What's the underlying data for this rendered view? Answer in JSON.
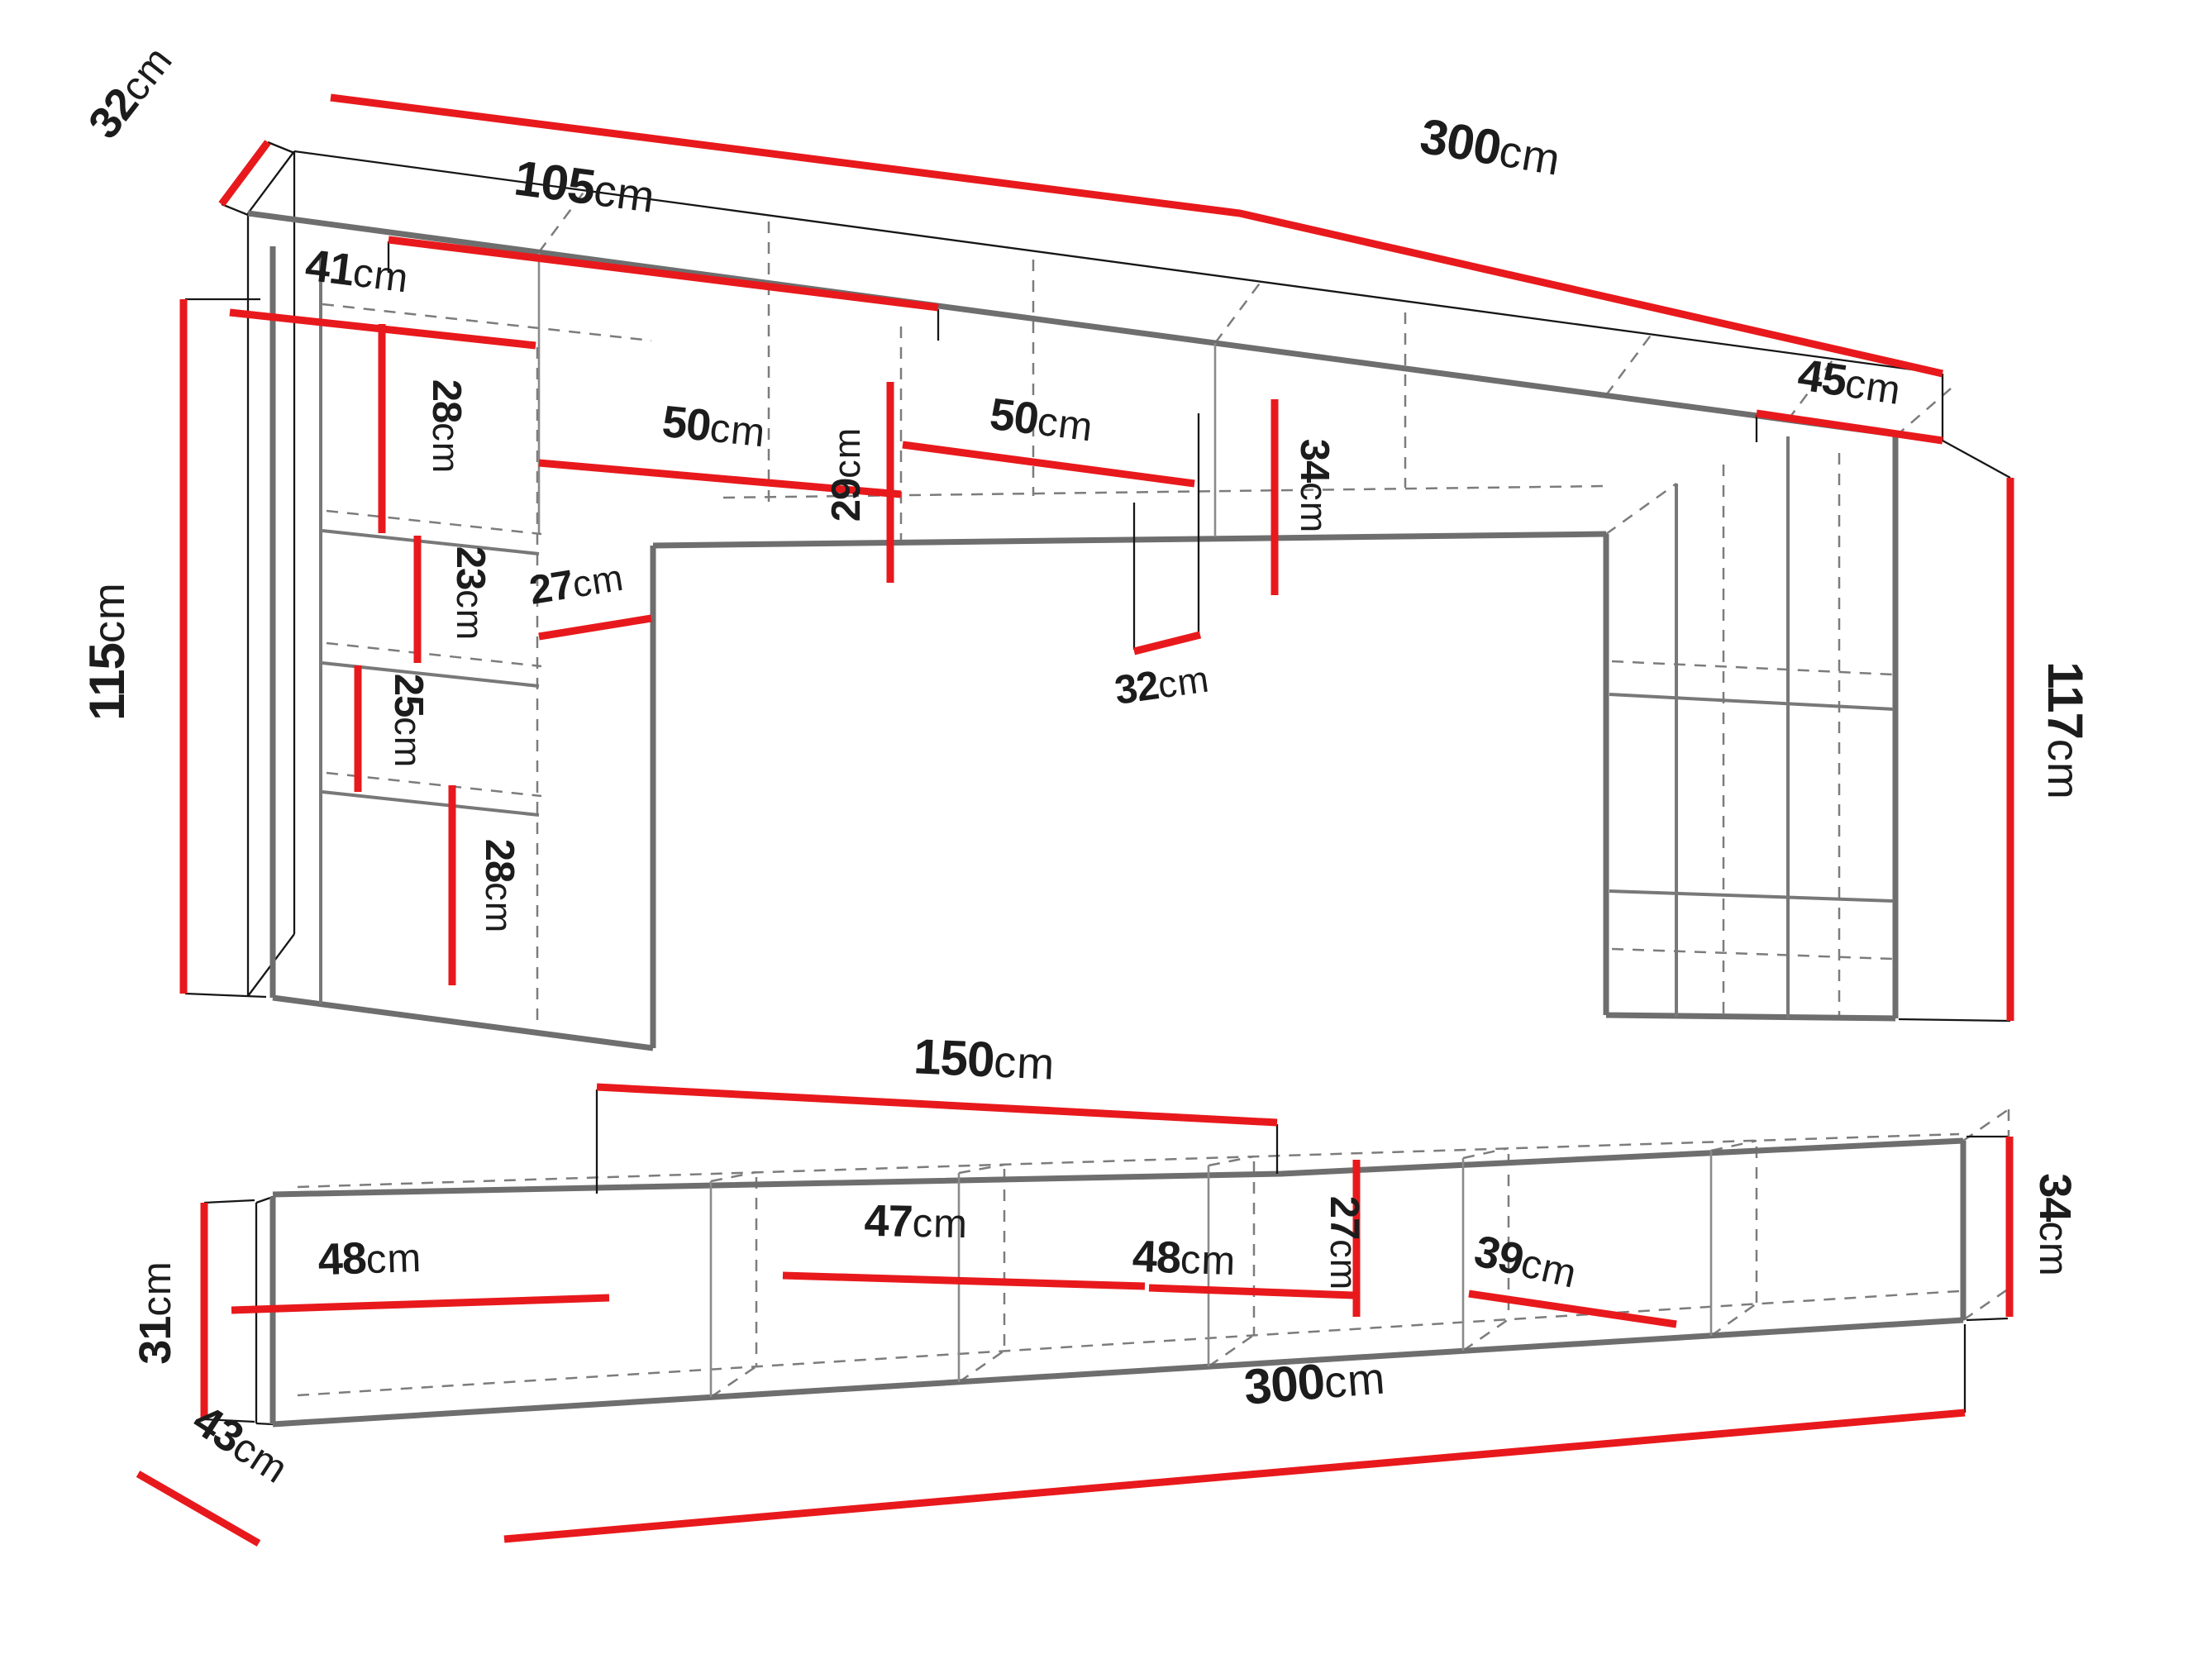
{
  "diagram_title": "wall unit and tv stand dimension drawing",
  "colors": {
    "dimension_red": "#e8191c",
    "furniture_gray": "#6e6e6e",
    "hidden_line_gray": "#7c7c7c",
    "text_black": "#1c1c1c",
    "background": "#ffffff"
  },
  "upper_view": {
    "description": "wall unit bridge with left and right towers",
    "dims": {
      "depth_left": {
        "num": "32",
        "unit": "cm"
      },
      "total_width": {
        "num": "300",
        "unit": "cm"
      },
      "inner_width": {
        "num": "105",
        "unit": "cm"
      },
      "shelf_width": {
        "num": "41",
        "unit": "cm"
      },
      "sec_h1": {
        "num": "28",
        "unit": "cm"
      },
      "sec_h2": {
        "num": "23",
        "unit": "cm"
      },
      "sec_h3": {
        "num": "25",
        "unit": "cm"
      },
      "niche_depth": {
        "num": "27",
        "unit": "cm"
      },
      "sec_h4": {
        "num": "28",
        "unit": "cm"
      },
      "tower_left_h": {
        "num": "115",
        "unit": "cm"
      },
      "cab_w1": {
        "num": "50",
        "unit": "cm"
      },
      "cab_h_mid": {
        "num": "29",
        "unit": "cm"
      },
      "cab_w2": {
        "num": "50",
        "unit": "cm"
      },
      "bridge_h": {
        "num": "34",
        "unit": "cm"
      },
      "mid_depth": {
        "num": "32",
        "unit": "cm"
      },
      "right_cab_w": {
        "num": "45",
        "unit": "cm"
      },
      "tower_right_h": {
        "num": "117",
        "unit": "cm"
      }
    }
  },
  "lower_view": {
    "description": "low tv stand row",
    "dims": {
      "half_width": {
        "num": "150",
        "unit": "cm"
      },
      "left_h": {
        "num": "31",
        "unit": "cm"
      },
      "sec_w1": {
        "num": "48",
        "unit": "cm"
      },
      "sec_w2": {
        "num": "47",
        "unit": "cm"
      },
      "sec_w3": {
        "num": "48",
        "unit": "cm"
      },
      "inner_h": {
        "num": "27",
        "unit": "cm"
      },
      "sec_w4": {
        "num": "39",
        "unit": "cm"
      },
      "right_h": {
        "num": "34",
        "unit": "cm"
      },
      "depth": {
        "num": "43",
        "unit": "cm"
      },
      "total_width": {
        "num": "300",
        "unit": "cm"
      }
    }
  }
}
